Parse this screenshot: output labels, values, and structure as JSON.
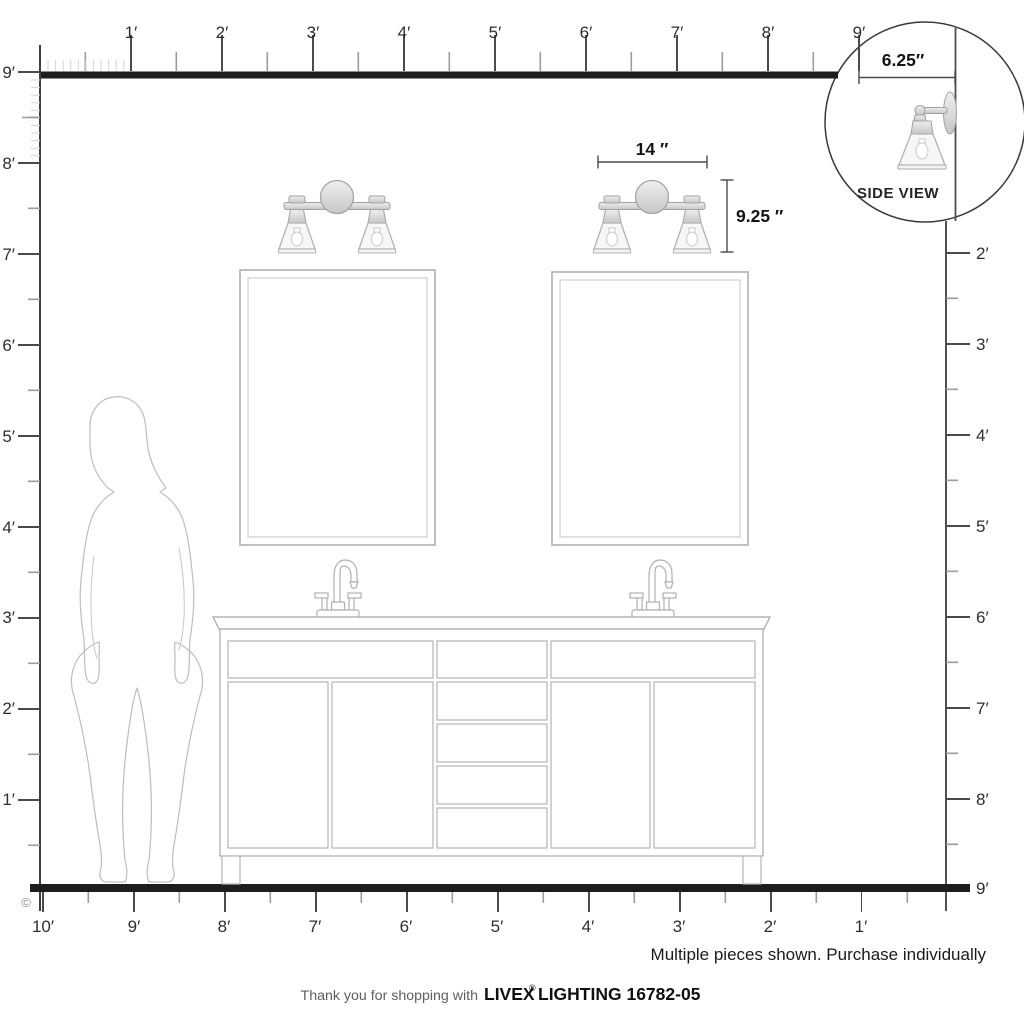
{
  "inset": {
    "depth_label": "6.25″",
    "title": "SIDE VIEW"
  },
  "dimensions": {
    "width_label": "14 ″",
    "height_label": "9.25 ″"
  },
  "rulers": {
    "top": {
      "labels": [
        "1′",
        "2′",
        "3′",
        "4′",
        "5′",
        "6′",
        "7′",
        "8′",
        "9′"
      ]
    },
    "left": {
      "labels": [
        "9′",
        "8′",
        "7′",
        "6′",
        "5′",
        "4′",
        "3′",
        "2′",
        "1′"
      ]
    },
    "right": {
      "labels": [
        "2′",
        "3′",
        "4′",
        "5′",
        "6′",
        "7′",
        "8′",
        "9′"
      ]
    },
    "bottom": {
      "labels": [
        "10′",
        "9′",
        "8′",
        "7′",
        "6′",
        "5′",
        "4′",
        "3′",
        "2′",
        "1′"
      ]
    }
  },
  "notes": {
    "purchase": "Multiple pieces shown. Purchase individually",
    "copyright": "©"
  },
  "footer": {
    "prefix": "Thank you for shopping with",
    "brand": "LIVEX",
    "registered": "®",
    "suffix": "LIGHTING 16782-05"
  },
  "colors": {
    "ink": "#1d1d1d",
    "drawing_gray": "#b5b5b5",
    "dim_ink": "#141414"
  }
}
